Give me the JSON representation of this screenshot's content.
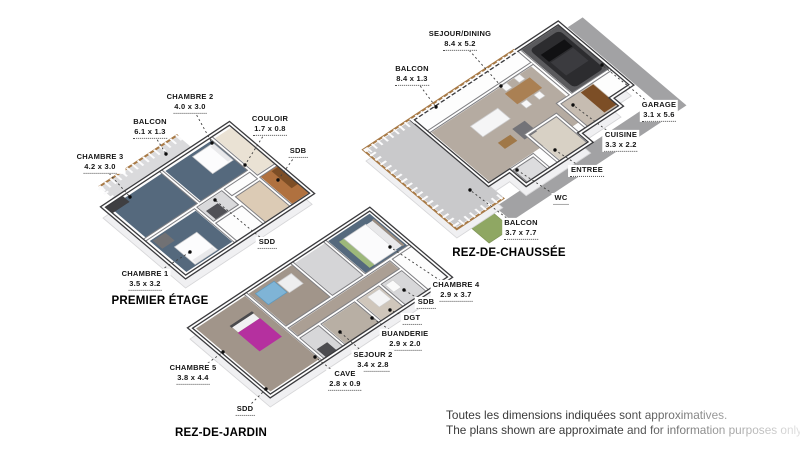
{
  "plans": [
    {
      "id": "premier-etage",
      "title": "PREMIER ÉTAGE",
      "labels": [
        {
          "name": "CHAMBRE 2",
          "dims": "4.0 x 3.0"
        },
        {
          "name": "BALCON",
          "dims": "6.1 x 1.3"
        },
        {
          "name": "CHAMBRE 3",
          "dims": "4.2 x 3.0"
        },
        {
          "name": "COULOIR",
          "dims": "1.7 x 0.8"
        },
        {
          "name": "SDB"
        },
        {
          "name": "SDD"
        },
        {
          "name": "CHAMBRE 1",
          "dims": "3.5 x 3.2"
        }
      ]
    },
    {
      "id": "rez-de-chaussee",
      "title": "REZ-DE-CHAUSSÉE",
      "labels": [
        {
          "name": "SEJOUR/DINING",
          "dims": "8.4 x 5.2"
        },
        {
          "name": "BALCON",
          "dims": "8.4 x 1.3"
        },
        {
          "name": "GARAGE",
          "dims": "3.1 x 5.6"
        },
        {
          "name": "CUISINE",
          "dims": "3.3 x 2.2"
        },
        {
          "name": "ENTREE"
        },
        {
          "name": "WC"
        },
        {
          "name": "BALCON",
          "dims": "3.7 x 7.7"
        }
      ]
    },
    {
      "id": "rez-de-jardin",
      "title": "REZ-DE-JARDIN",
      "labels": [
        {
          "name": "CHAMBRE 4",
          "dims": "2.9 x 3.7"
        },
        {
          "name": "SDB"
        },
        {
          "name": "DGT"
        },
        {
          "name": "BUANDERIE",
          "dims": "2.9 x 2.0"
        },
        {
          "name": "SEJOUR 2",
          "dims": "3.4 x 2.8"
        },
        {
          "name": "CAVE",
          "dims": "2.8 x 0.9"
        },
        {
          "name": "CHAMBRE 5",
          "dims": "3.8 x 4.4"
        },
        {
          "name": "SDD"
        }
      ]
    }
  ],
  "disclaimer": {
    "line1": "Toutes les dimensions indiquées sont approximatives.",
    "line2": "The plans shown are approximate and for information purposes only."
  },
  "colors": {
    "bedroom_floor_blue": "#55697d",
    "living_floor_taupe": "#b5aba1",
    "jardin_floor_taupe": "#a1958a",
    "bathroom_wood": "#b0713f",
    "terrace_concrete": "#c9c9cb",
    "driveway_gray": "#a2a2a4",
    "grass_green": "#8fa763",
    "wood_trim": "#a87a46",
    "car_dark": "#2c2c2f",
    "bed_magenta": "#b5309f",
    "sofa_blue": "#7fb4d6",
    "wall_dark": "#3b3b3e",
    "marker_black": "#0d0d0d"
  }
}
